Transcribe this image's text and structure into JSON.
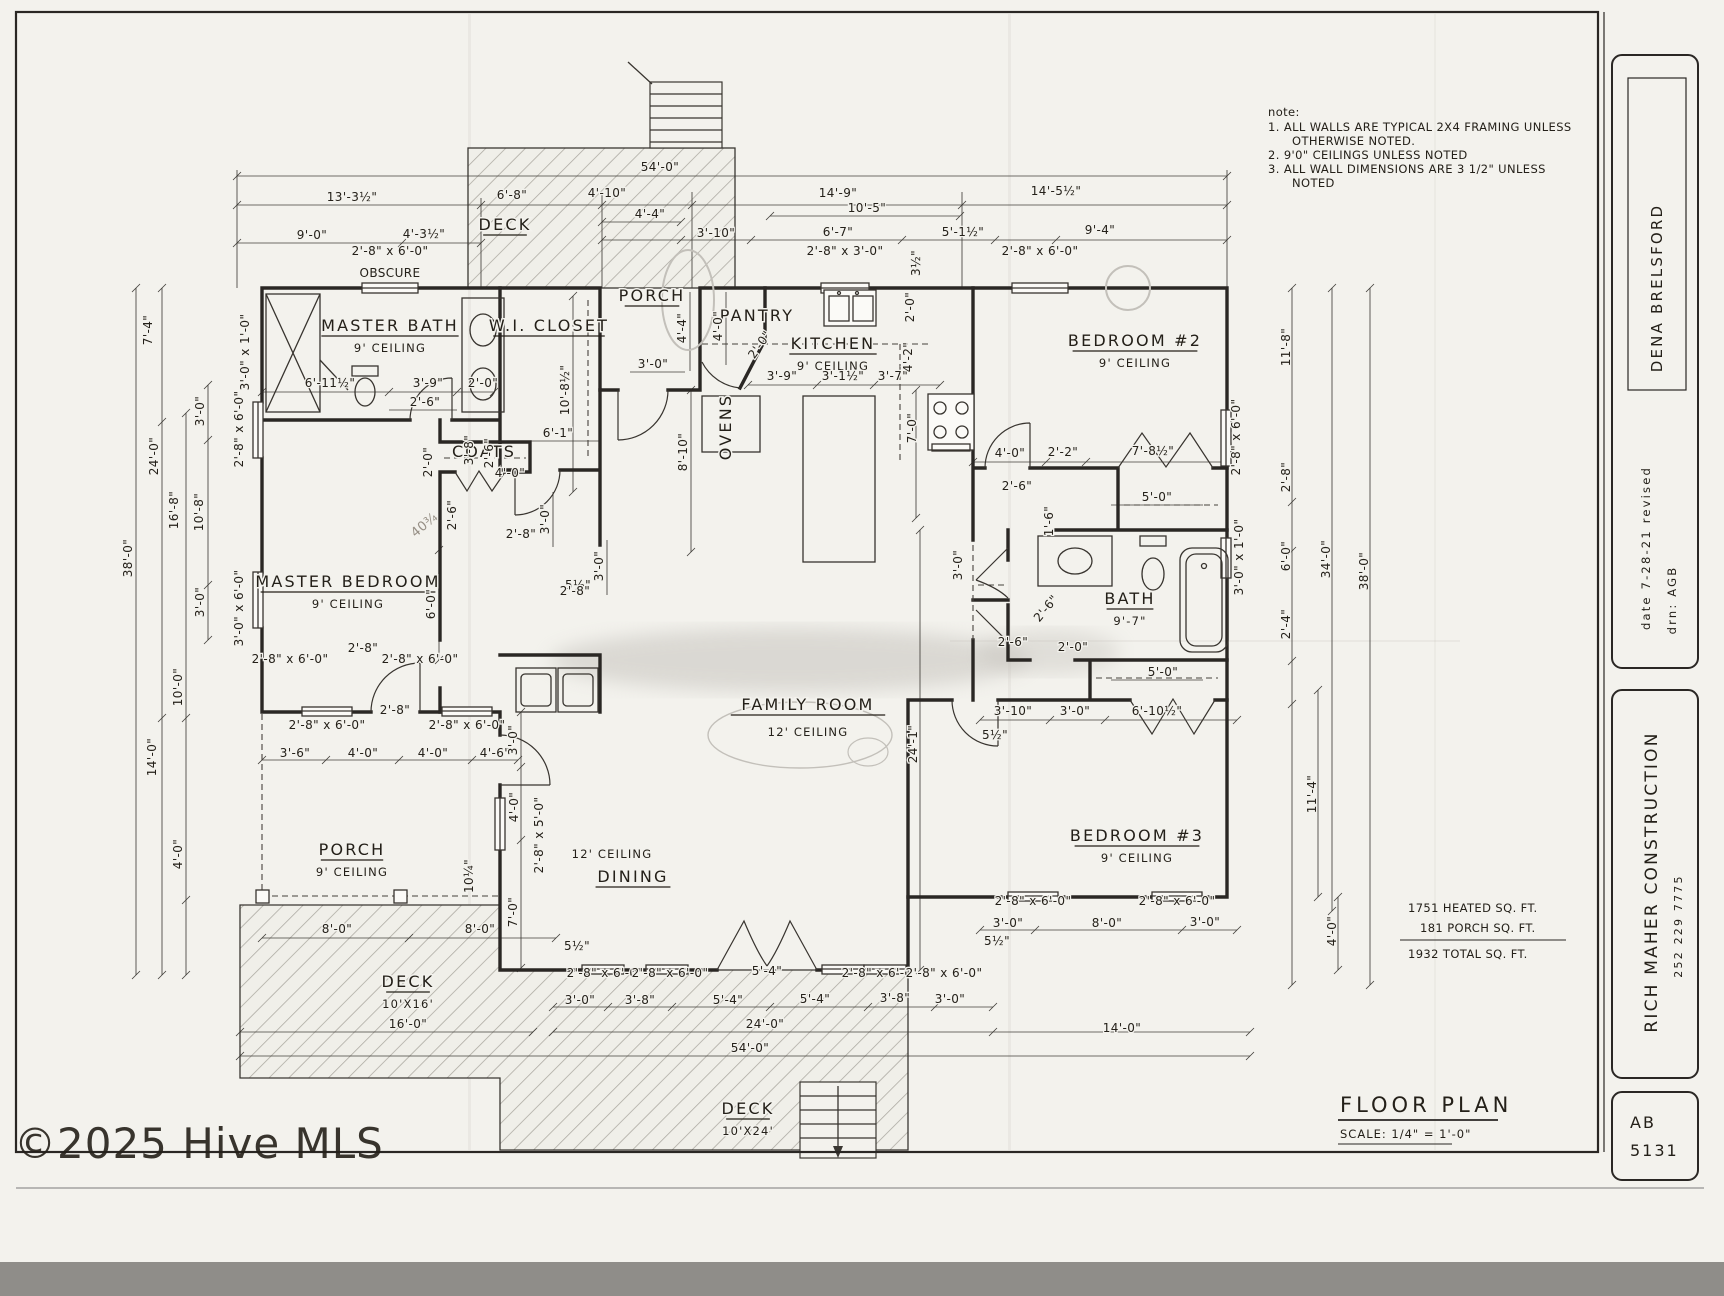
{
  "page": {
    "watermark": "©2025 Hive MLS"
  },
  "notes": {
    "heading": "note:",
    "items": [
      "1.  ALL WALLS ARE TYPICAL 2X4 FRAMING UNLESS",
      "OTHERWISE NOTED.",
      "2.  9'0\" CEILINGS UNLESS NOTED",
      "3.  ALL WALL DIMENSIONS ARE 3 1/2\" UNLESS",
      "NOTED"
    ]
  },
  "title_block": {
    "client": "DENA BRELSFORD",
    "date_line": "date  7-28-21    revised",
    "drawn_line": "drn:  AGB",
    "company": "RICH MAHER CONSTRUCTION",
    "phone": "252 229 7775",
    "sheet_prefix": "AB",
    "sheet_number": "5131"
  },
  "drawing_title": {
    "title": "FLOOR PLAN",
    "scale": "SCALE: 1/4\" = 1'-0\""
  },
  "area_summary": {
    "heated": "1751 HEATED SQ. FT.",
    "porch": "181 PORCH SQ. FT.",
    "total": "1932 TOTAL SQ. FT."
  },
  "plan": {
    "rooms": [
      {
        "label": "MASTER BATH",
        "sub": "9' CEILING",
        "x": 390,
        "y": 331,
        "u": true
      },
      {
        "label": "W.I. CLOSET",
        "x": 549,
        "y": 331,
        "u": true,
        "fs": 13
      },
      {
        "label": "PORCH",
        "x": 652,
        "y": 301,
        "u": true,
        "fs": 14
      },
      {
        "label": "PANTRY",
        "x": 757,
        "y": 321,
        "fs": 11
      },
      {
        "label": "KITCHEN",
        "sub": "9' CEILING",
        "x": 833,
        "y": 349,
        "u": true
      },
      {
        "label": "BEDROOM #2",
        "sub": "9' CEILING",
        "x": 1135,
        "y": 346,
        "u": true
      },
      {
        "label": "MASTER BEDROOM",
        "sub": "9' CEILING",
        "x": 348,
        "y": 587,
        "u": true
      },
      {
        "label": "COATS",
        "x": 484,
        "y": 457,
        "fs": 10
      },
      {
        "label": "BATH",
        "sub": "9'-7\"",
        "x": 1130,
        "y": 604,
        "u": true,
        "fs": 15,
        "subfs": 13
      },
      {
        "label": "FAMILY ROOM",
        "sub": "12' CEILING",
        "x": 808,
        "y": 710,
        "u": true,
        "fs": 18,
        "dy": 26
      },
      {
        "label": "BEDROOM #3",
        "sub": "9' CEILING",
        "x": 1137,
        "y": 841,
        "u": true
      },
      {
        "label": "PORCH",
        "sub": "9' CEILING",
        "x": 352,
        "y": 855,
        "u": true
      },
      {
        "label": "DINING",
        "x": 633,
        "y": 882,
        "u": true
      },
      {
        "label": "DECK",
        "x": 505,
        "y": 230,
        "u": true,
        "fs": 14
      },
      {
        "label": "DECK",
        "sub": "10'X16'",
        "x": 408,
        "y": 987,
        "u": true,
        "fs": 14,
        "subfs": 10
      },
      {
        "label": "DECK",
        "sub": "10'X24'",
        "x": 748,
        "y": 1114,
        "u": true,
        "fs": 14,
        "subfs": 10
      },
      {
        "label": "OVENS",
        "x": 731,
        "y": 427,
        "r": -90,
        "fs": 8
      }
    ],
    "dimensions": [
      {
        "t": "54'-0\"",
        "x": 660,
        "y": 171
      },
      {
        "t": "13'-3½\"",
        "x": 352,
        "y": 201
      },
      {
        "t": "6'-8\"",
        "x": 512,
        "y": 199
      },
      {
        "t": "4'-10\"",
        "x": 607,
        "y": 197
      },
      {
        "t": "14'-9\"",
        "x": 838,
        "y": 197
      },
      {
        "t": "14'-5½\"",
        "x": 1056,
        "y": 195
      },
      {
        "t": "9'-0\"",
        "x": 312,
        "y": 239
      },
      {
        "t": "4'-3½\"",
        "x": 424,
        "y": 238
      },
      {
        "t": "4'-4\"",
        "x": 650,
        "y": 218
      },
      {
        "t": "3'-10\"",
        "x": 716,
        "y": 237
      },
      {
        "t": "10'-5\"",
        "x": 867,
        "y": 212
      },
      {
        "t": "6'-7\"",
        "x": 838,
        "y": 236
      },
      {
        "t": "5'-1½\"",
        "x": 963,
        "y": 236
      },
      {
        "t": "9'-4\"",
        "x": 1100,
        "y": 234
      },
      {
        "t": "2'-8\" x 6'-0\"",
        "x": 390,
        "y": 255
      },
      {
        "t": "OBSCURE",
        "x": 390,
        "y": 277
      },
      {
        "t": "2'-8\" x 3'-0\"",
        "x": 845,
        "y": 255
      },
      {
        "t": "3½\"",
        "x": 920,
        "y": 263,
        "r": -90
      },
      {
        "t": "2'-8\" x 6'-0\"",
        "x": 1040,
        "y": 255
      },
      {
        "t": "3'-0\" x 1'-0\"",
        "x": 249,
        "y": 352,
        "r": -90
      },
      {
        "t": "6'-11½\"",
        "x": 330,
        "y": 387
      },
      {
        "t": "3'-9\"",
        "x": 428,
        "y": 387
      },
      {
        "t": "2'-0\"",
        "x": 483,
        "y": 387
      },
      {
        "t": "2'-6\"",
        "x": 425,
        "y": 406
      },
      {
        "t": "10'-8½\"",
        "x": 569,
        "y": 390,
        "r": -90
      },
      {
        "t": "6'-1\"",
        "x": 558,
        "y": 437
      },
      {
        "t": "3'-8\"",
        "x": 473,
        "y": 450,
        "r": -90
      },
      {
        "t": "2'-6\"",
        "x": 493,
        "y": 453,
        "r": -90
      },
      {
        "t": "7'-4\"",
        "x": 152,
        "y": 330,
        "r": -90
      },
      {
        "t": "24'-0\"",
        "x": 158,
        "y": 456,
        "r": -90
      },
      {
        "t": "38'-0\"",
        "x": 132,
        "y": 558,
        "r": -90
      },
      {
        "t": "16'-8\"",
        "x": 178,
        "y": 510,
        "r": -90
      },
      {
        "t": "10'-8\"",
        "x": 203,
        "y": 512,
        "r": -90
      },
      {
        "t": "3'-0\"",
        "x": 204,
        "y": 411,
        "r": -90
      },
      {
        "t": "3'-0\"",
        "x": 204,
        "y": 602,
        "r": -90
      },
      {
        "t": "10'-0\"",
        "x": 182,
        "y": 687,
        "r": -90
      },
      {
        "t": "14'-0\"",
        "x": 156,
        "y": 757,
        "r": -90
      },
      {
        "t": "4'-0\"",
        "x": 182,
        "y": 854,
        "r": -90
      },
      {
        "t": "2'-8\" x 6'-0\"",
        "x": 243,
        "y": 429,
        "r": -90
      },
      {
        "t": "3'-0\" x 6'-0\"",
        "x": 243,
        "y": 608,
        "r": -90
      },
      {
        "t": "4'-4\"",
        "x": 686,
        "y": 328,
        "r": -90
      },
      {
        "t": "4'-0\"",
        "x": 722,
        "y": 326,
        "r": -90
      },
      {
        "t": "2'-0\"",
        "x": 763,
        "y": 347,
        "r": -55
      },
      {
        "t": "3'-0\"",
        "x": 653,
        "y": 368
      },
      {
        "t": "3'-9\"",
        "x": 782,
        "y": 380
      },
      {
        "t": "3'-1½\"",
        "x": 843,
        "y": 380
      },
      {
        "t": "3'-7\"",
        "x": 893,
        "y": 380
      },
      {
        "t": "4'-2\"",
        "x": 912,
        "y": 357,
        "r": -90
      },
      {
        "t": "2'-0\"",
        "x": 914,
        "y": 307,
        "r": -90
      },
      {
        "t": "7'-0\"",
        "x": 916,
        "y": 428,
        "r": -90
      },
      {
        "t": "8'-10\"",
        "x": 687,
        "y": 452,
        "r": -90
      },
      {
        "t": "4'-0\"",
        "x": 510,
        "y": 477
      },
      {
        "t": "2'-0\"",
        "x": 432,
        "y": 462,
        "r": -90
      },
      {
        "t": "2'-6\"",
        "x": 456,
        "y": 515,
        "r": -90
      },
      {
        "t": "3'-0\"",
        "x": 549,
        "y": 519,
        "r": -90
      },
      {
        "t": "2'-8\"",
        "x": 521,
        "y": 538
      },
      {
        "t": "5½\"",
        "x": 578,
        "y": 589
      },
      {
        "t": "6'-0\"",
        "x": 435,
        "y": 604,
        "r": -90
      },
      {
        "t": "2'-8\"",
        "x": 363,
        "y": 652
      },
      {
        "t": "40¾",
        "x": 427,
        "y": 528,
        "r": -40,
        "cls": "pencil"
      },
      {
        "t": "3'-0\"",
        "x": 603,
        "y": 566,
        "r": -90
      },
      {
        "t": "2'-8\"",
        "x": 575,
        "y": 595
      },
      {
        "t": "4'-0\"",
        "x": 1010,
        "y": 457
      },
      {
        "t": "2'-2\"",
        "x": 1063,
        "y": 456
      },
      {
        "t": "7'-8½\"",
        "x": 1153,
        "y": 455
      },
      {
        "t": "2'-6\"",
        "x": 1017,
        "y": 490
      },
      {
        "t": "2'-8\" x 6'-0\"",
        "x": 1240,
        "y": 437,
        "r": -90
      },
      {
        "t": "1'-6\"",
        "x": 1053,
        "y": 521,
        "r": -90
      },
      {
        "t": "5'-0\"",
        "x": 1157,
        "y": 501
      },
      {
        "t": "3'-0\"",
        "x": 962,
        "y": 565,
        "r": -90
      },
      {
        "t": "2'-6\"",
        "x": 1049,
        "y": 611,
        "r": -50
      },
      {
        "t": "2'-6\"",
        "x": 1013,
        "y": 646
      },
      {
        "t": "2'-0\"",
        "x": 1073,
        "y": 651
      },
      {
        "t": "5'-0\"",
        "x": 1163,
        "y": 676
      },
      {
        "t": "3'-10\"",
        "x": 1013,
        "y": 715
      },
      {
        "t": "3'-0\"",
        "x": 1075,
        "y": 715
      },
      {
        "t": "6'-10½\"",
        "x": 1157,
        "y": 715
      },
      {
        "t": "3'-0\" x 1'-0\"",
        "x": 1243,
        "y": 557,
        "r": -90
      },
      {
        "t": "24'-1\"",
        "x": 917,
        "y": 744,
        "r": -90
      },
      {
        "t": "5½\"",
        "x": 995,
        "y": 739
      },
      {
        "t": "12' CEILING",
        "x": 612,
        "y": 858,
        "cls": "sub"
      },
      {
        "t": "2'-8\" x 6'-0\"",
        "x": 290,
        "y": 663
      },
      {
        "t": "2'-8\" x 6'-0\"",
        "x": 420,
        "y": 663
      },
      {
        "t": "2'-8\" x 6'-0\"",
        "x": 327,
        "y": 729
      },
      {
        "t": "2'-8\" x 6'-0\"",
        "x": 467,
        "y": 729
      },
      {
        "t": "2'-8\"",
        "x": 395,
        "y": 714
      },
      {
        "t": "3'-6\"",
        "x": 295,
        "y": 757
      },
      {
        "t": "4'-0\"",
        "x": 363,
        "y": 757
      },
      {
        "t": "4'-0\"",
        "x": 433,
        "y": 757
      },
      {
        "t": "4'-6\"",
        "x": 495,
        "y": 757
      },
      {
        "t": "3'-0\"",
        "x": 517,
        "y": 740,
        "r": -90
      },
      {
        "t": "4'-0\"",
        "x": 518,
        "y": 807,
        "r": -90
      },
      {
        "t": "2'-8\" x 5'-0\"",
        "x": 543,
        "y": 835,
        "r": -90
      },
      {
        "t": "10¼\"",
        "x": 473,
        "y": 876,
        "r": -90
      },
      {
        "t": "7'-0\"",
        "x": 517,
        "y": 912,
        "r": -90
      },
      {
        "t": "8'-0\"",
        "x": 337,
        "y": 933
      },
      {
        "t": "8'-0\"",
        "x": 480,
        "y": 933
      },
      {
        "t": "16'-0\"",
        "x": 408,
        "y": 1028
      },
      {
        "t": "5½\"",
        "x": 577,
        "y": 950
      },
      {
        "t": "2'-8\" x 6'-0\"",
        "x": 605,
        "y": 977
      },
      {
        "t": "2'-8\" x 6'-0\"",
        "x": 670,
        "y": 977
      },
      {
        "t": "5'-4\"",
        "x": 767,
        "y": 975
      },
      {
        "t": "2'-8\" x 6'-0\"",
        "x": 880,
        "y": 977
      },
      {
        "t": "2'-8\" x 6'-0\"",
        "x": 944,
        "y": 977
      },
      {
        "t": "3'-0\"",
        "x": 580,
        "y": 1004
      },
      {
        "t": "3'-8\"",
        "x": 640,
        "y": 1004
      },
      {
        "t": "5'-4\"",
        "x": 728,
        "y": 1004
      },
      {
        "t": "5'-4\"",
        "x": 815,
        "y": 1003
      },
      {
        "t": "3'-8\"",
        "x": 895,
        "y": 1002
      },
      {
        "t": "3'-0\"",
        "x": 950,
        "y": 1003
      },
      {
        "t": "24'-0\"",
        "x": 765,
        "y": 1028
      },
      {
        "t": "54'-0\"",
        "x": 750,
        "y": 1052
      },
      {
        "t": "14'-0\"",
        "x": 1122,
        "y": 1032
      },
      {
        "t": "5½\"",
        "x": 997,
        "y": 945
      },
      {
        "t": "2'-8\" x 6'-0\"",
        "x": 1033,
        "y": 905
      },
      {
        "t": "2'-8\" x 6'-0\"",
        "x": 1177,
        "y": 905
      },
      {
        "t": "3'-0\"",
        "x": 1008,
        "y": 927
      },
      {
        "t": "8'-0\"",
        "x": 1107,
        "y": 927
      },
      {
        "t": "3'-0\"",
        "x": 1205,
        "y": 926
      },
      {
        "t": "11'-8\"",
        "x": 1290,
        "y": 347,
        "r": -90
      },
      {
        "t": "2'-8\"",
        "x": 1290,
        "y": 477,
        "r": -90
      },
      {
        "t": "6'-0\"",
        "x": 1290,
        "y": 556,
        "r": -90
      },
      {
        "t": "2'-4\"",
        "x": 1290,
        "y": 624,
        "r": -90
      },
      {
        "t": "34'-0\"",
        "x": 1330,
        "y": 559,
        "r": -90
      },
      {
        "t": "38'-0\"",
        "x": 1368,
        "y": 571,
        "r": -90
      },
      {
        "t": "11'-4\"",
        "x": 1316,
        "y": 794,
        "r": -90
      },
      {
        "t": "4'-0\"",
        "x": 1336,
        "y": 931,
        "r": -90
      }
    ]
  }
}
